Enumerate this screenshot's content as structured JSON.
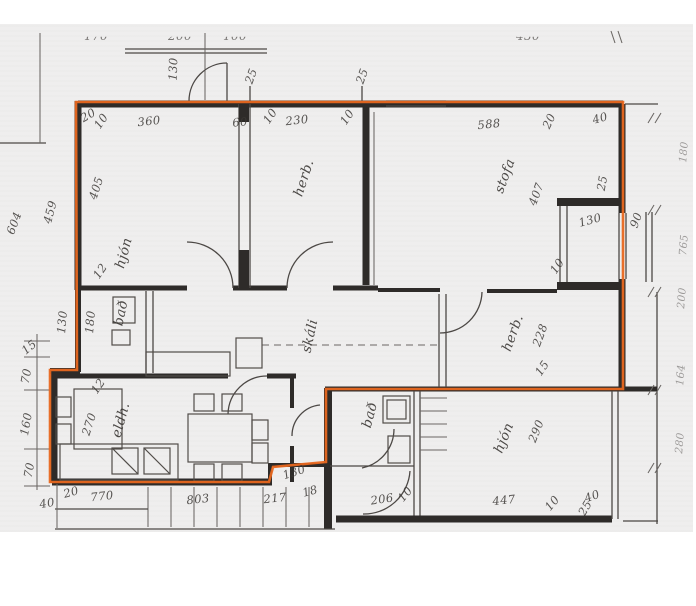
{
  "document": {
    "kind": "scanned architectural floor plan",
    "language": "Icelandic",
    "highlight_meaning": "apartment boundary outline"
  },
  "colors": {
    "paper": "#efeeee",
    "ink": "#2e2b29",
    "highlight": "#e8671f"
  },
  "labels": {
    "rooms": [
      {
        "text": "hjón",
        "x": 124,
        "y": 253,
        "rot": -75
      },
      {
        "text": "herb.",
        "x": 304,
        "y": 178,
        "rot": -72
      },
      {
        "text": "stofa",
        "x": 505,
        "y": 176,
        "rot": -70
      },
      {
        "text": "herb.",
        "x": 513,
        "y": 333,
        "rot": -70
      },
      {
        "text": "skáli",
        "x": 310,
        "y": 336,
        "rot": -78
      },
      {
        "text": "bað",
        "x": 121,
        "y": 313,
        "rot": -78
      },
      {
        "text": "eldh.",
        "x": 121,
        "y": 420,
        "rot": -75
      },
      {
        "text": "bað",
        "x": 370,
        "y": 415,
        "rot": -75
      },
      {
        "text": "hjón",
        "x": 504,
        "y": 438,
        "rot": -68
      }
    ],
    "dims": [
      {
        "text": "130",
        "x": 173,
        "y": 69,
        "rot": -88
      },
      {
        "text": "25",
        "x": 251,
        "y": 76,
        "rot": -70
      },
      {
        "text": "25",
        "x": 362,
        "y": 76,
        "rot": -70
      },
      {
        "text": "20",
        "x": 88,
        "y": 115,
        "rot": -30
      },
      {
        "text": "10",
        "x": 101,
        "y": 121,
        "rot": -55
      },
      {
        "text": "360",
        "x": 149,
        "y": 121,
        "rot": -6
      },
      {
        "text": "60",
        "x": 240,
        "y": 122,
        "rot": -6
      },
      {
        "text": "10",
        "x": 270,
        "y": 116,
        "rot": -55
      },
      {
        "text": "230",
        "x": 297,
        "y": 120,
        "rot": -6
      },
      {
        "text": "10",
        "x": 347,
        "y": 117,
        "rot": -55
      },
      {
        "text": "588",
        "x": 489,
        "y": 124,
        "rot": -6
      },
      {
        "text": "20",
        "x": 549,
        "y": 121,
        "rot": -65
      },
      {
        "text": "40",
        "x": 600,
        "y": 118,
        "rot": -15
      },
      {
        "text": "405",
        "x": 96,
        "y": 188,
        "rot": -72
      },
      {
        "text": "459",
        "x": 50,
        "y": 212,
        "rot": -75
      },
      {
        "text": "604",
        "x": 14,
        "y": 223,
        "rot": -70
      },
      {
        "text": "12",
        "x": 100,
        "y": 271,
        "rot": -55
      },
      {
        "text": "407",
        "x": 536,
        "y": 194,
        "rot": -70
      },
      {
        "text": "25",
        "x": 602,
        "y": 183,
        "rot": -80
      },
      {
        "text": "130",
        "x": 590,
        "y": 220,
        "rot": -15
      },
      {
        "text": "90",
        "x": 636,
        "y": 220,
        "rot": -70
      },
      {
        "text": "10",
        "x": 557,
        "y": 266,
        "rot": -55
      },
      {
        "text": "130",
        "x": 62,
        "y": 322,
        "rot": -85
      },
      {
        "text": "180",
        "x": 90,
        "y": 322,
        "rot": -85
      },
      {
        "text": "15",
        "x": 29,
        "y": 347,
        "rot": -40
      },
      {
        "text": "70",
        "x": 26,
        "y": 376,
        "rot": -80
      },
      {
        "text": "160",
        "x": 26,
        "y": 424,
        "rot": -80
      },
      {
        "text": "70",
        "x": 29,
        "y": 470,
        "rot": -80
      },
      {
        "text": "228",
        "x": 540,
        "y": 335,
        "rot": -70
      },
      {
        "text": "15",
        "x": 542,
        "y": 368,
        "rot": -55
      },
      {
        "text": "270",
        "x": 89,
        "y": 424,
        "rot": -72
      },
      {
        "text": "12",
        "x": 98,
        "y": 386,
        "rot": -55
      },
      {
        "text": "40",
        "x": 47,
        "y": 503,
        "rot": -10
      },
      {
        "text": "20",
        "x": 71,
        "y": 492,
        "rot": -15
      },
      {
        "text": "770",
        "x": 102,
        "y": 496,
        "rot": -6
      },
      {
        "text": "803",
        "x": 198,
        "y": 499,
        "rot": -6
      },
      {
        "text": "217",
        "x": 275,
        "y": 498,
        "rot": -6
      },
      {
        "text": "18",
        "x": 310,
        "y": 491,
        "rot": -15
      },
      {
        "text": "130",
        "x": 294,
        "y": 472,
        "rot": -18
      },
      {
        "text": "290",
        "x": 536,
        "y": 431,
        "rot": -68
      },
      {
        "text": "447",
        "x": 504,
        "y": 500,
        "rot": -6
      },
      {
        "text": "206",
        "x": 382,
        "y": 499,
        "rot": -8
      },
      {
        "text": "10",
        "x": 405,
        "y": 494,
        "rot": -50
      },
      {
        "text": "10",
        "x": 552,
        "y": 503,
        "rot": -50
      },
      {
        "text": "40",
        "x": 592,
        "y": 496,
        "rot": -20
      },
      {
        "text": "25",
        "x": 585,
        "y": 508,
        "rot": -60
      }
    ],
    "edge_dims": [
      {
        "text": "180",
        "x": 684,
        "y": 152,
        "rot": -85
      },
      {
        "text": "765",
        "x": 684,
        "y": 245,
        "rot": -85
      },
      {
        "text": "200",
        "x": 682,
        "y": 298,
        "rot": -85
      },
      {
        "text": "164",
        "x": 681,
        "y": 375,
        "rot": -85
      },
      {
        "text": "280",
        "x": 680,
        "y": 443,
        "rot": -85
      }
    ],
    "clipped_top": [
      {
        "text": "170",
        "x": 96,
        "y": 36
      },
      {
        "text": "200",
        "x": 180,
        "y": 36
      },
      {
        "text": "100",
        "x": 235,
        "y": 36
      },
      {
        "text": "430",
        "x": 528,
        "y": 36
      }
    ]
  }
}
